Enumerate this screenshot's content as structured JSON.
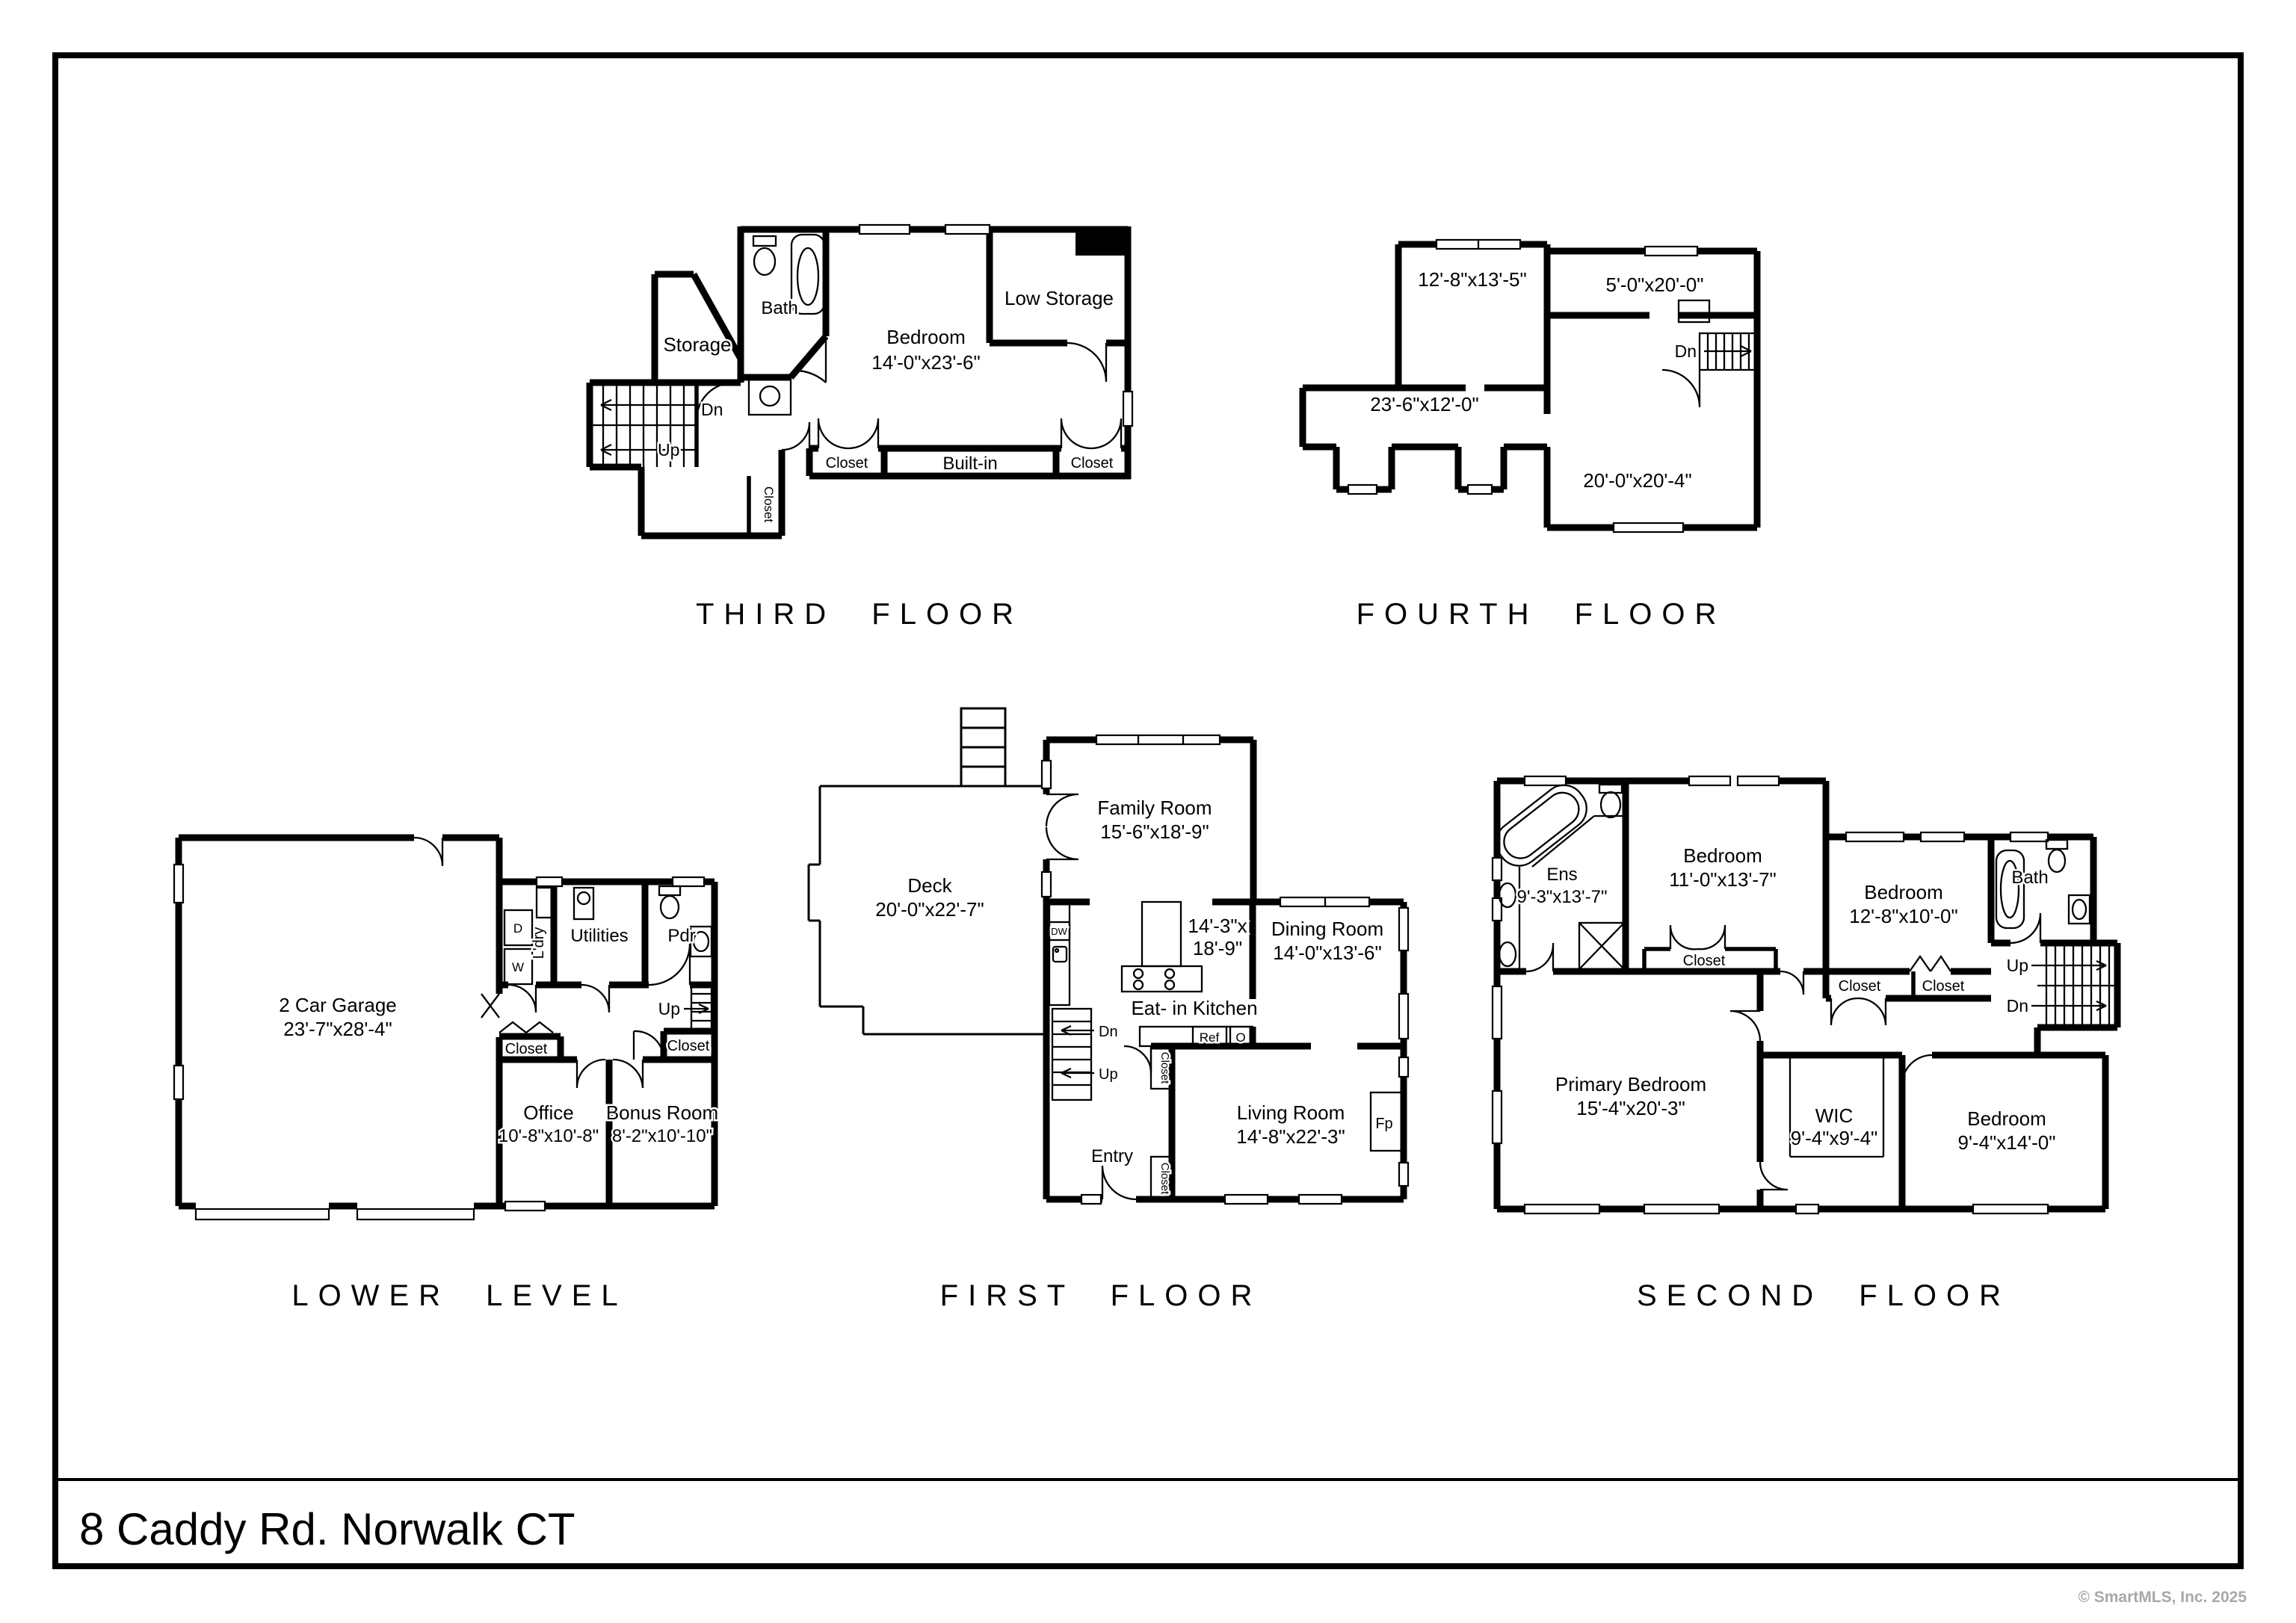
{
  "frame": {
    "address": "8 Caddy Rd. Norwalk CT",
    "copyright": "© SmartMLS, Inc.  2025"
  },
  "colors": {
    "wall": "#000000",
    "background": "#ffffff",
    "watermark": "#a8a8a8"
  },
  "floors": {
    "third": {
      "title": "THIRD FLOOR",
      "labels": {
        "bath": "Bath",
        "storage": "Storage",
        "bedroom_name": "Bedroom",
        "bedroom_dims": "14'-0\"x23'-6\"",
        "low_storage": "Low Storage",
        "closet_left": "Closet",
        "built_in": "Built-in",
        "closet_right": "Closet",
        "closet_hall": "Closet",
        "dn": "Dn",
        "up": "Up"
      }
    },
    "fourth": {
      "title": "FOURTH FLOOR",
      "labels": {
        "room_a": "12'-8\"x13'-5\"",
        "room_b": "5'-0\"x20'-0\"",
        "room_c": "23'-6\"x12'-0\"",
        "room_d": "20'-0\"x20'-4\"",
        "dn": "Dn"
      }
    },
    "lower": {
      "title": "LOWER LEVEL",
      "labels": {
        "garage_name": "2 Car Garage",
        "garage_dims": "23'-7\"x28'-4\"",
        "ldry": "L'dry",
        "d": "D",
        "w": "W",
        "utilities": "Utilities",
        "pdr": "Pdr",
        "up": "Up",
        "closet_left": "Closet",
        "closet_right": "Closet",
        "office_name": "Office",
        "office_dims": "10'-8\"x10'-8\"",
        "bonus_name": "Bonus Room",
        "bonus_dims": "8'-2\"x10'-10\""
      }
    },
    "first": {
      "title": "FIRST FLOOR",
      "labels": {
        "deck_name": "Deck",
        "deck_dims": "20'-0\"x22'-7\"",
        "family_name": "Family Room",
        "family_dims": "15'-6\"x18'-9\"",
        "kitchen_dims_a": "14'-3\"x",
        "kitchen_dims_b": "18'-9\"",
        "kitchen_name": "Eat- in Kitchen",
        "dining_name": "Dining Room",
        "dining_dims": "14'-0\"x13'-6\"",
        "living_name": "Living Room",
        "living_dims": "14'-8\"x22'-3\"",
        "dw": "DW",
        "ref": "Ref",
        "o": "O",
        "fp": "Fp",
        "dn": "Dn",
        "up": "Up",
        "closet_a": "Closet",
        "closet_b": "Closet",
        "entry": "Entry"
      }
    },
    "second": {
      "title": "SECOND FLOOR",
      "labels": {
        "ens_name": "Ens",
        "ens_dims": "9'-3\"x13'-7\"",
        "bedroom1_name": "Bedroom",
        "bedroom1_dims": "11'-0\"x13'-7\"",
        "bedroom2_name": "Bedroom",
        "bedroom2_dims": "12'-8\"x10'-0\"",
        "bath": "Bath",
        "up": "Up",
        "dn": "Dn",
        "closet1": "Closet",
        "closet2": "Closet",
        "closet3": "Closet",
        "primary_name": "Primary Bedroom",
        "primary_dims": "15'-4\"x20'-3\"",
        "wic_name": "WIC",
        "wic_dims": "9'-4\"x9'-4\"",
        "bedroom3_name": "Bedroom",
        "bedroom3_dims": "9'-4\"x14'-0\""
      }
    }
  }
}
